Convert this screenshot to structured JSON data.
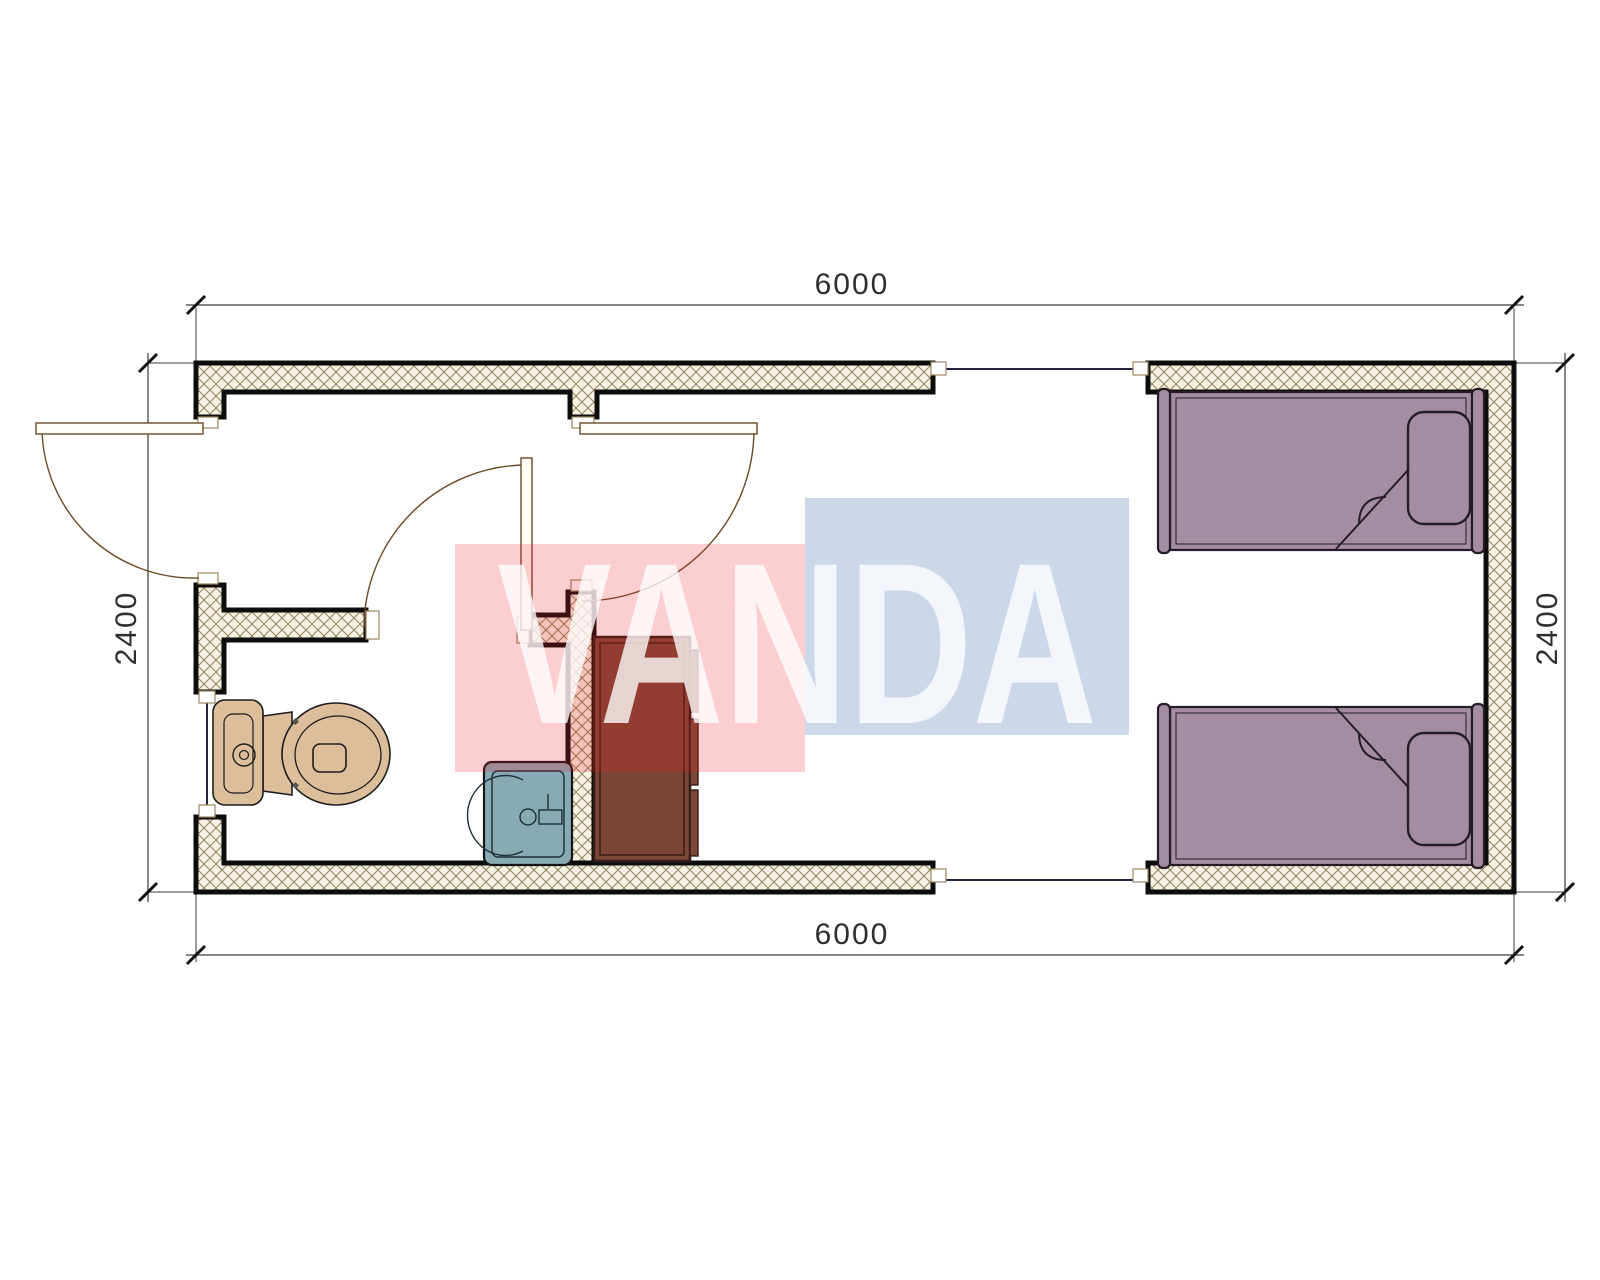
{
  "title": "Container house floor plan 6000 x 2400",
  "watermark": {
    "text": "VANDA",
    "red_block_rgba": "rgba(237,28,36,0.21)",
    "blue_block_rgba": "rgba(25,78,158,0.22)"
  },
  "dimensions": {
    "top": "6000",
    "bottom": "6000",
    "left": "2400",
    "right": "2400"
  },
  "colors": {
    "wall_fill": "#F6F1E3",
    "wall_hatch_line": "#8F855F",
    "wall_outline": "#0d0d0d",
    "door_line": "#6B4A28",
    "window_line": "#23234A",
    "toilet": "#DCBE9B",
    "sink": "#88AAB4",
    "cabinet": "#7C4636",
    "bed": "#A48DA0"
  }
}
